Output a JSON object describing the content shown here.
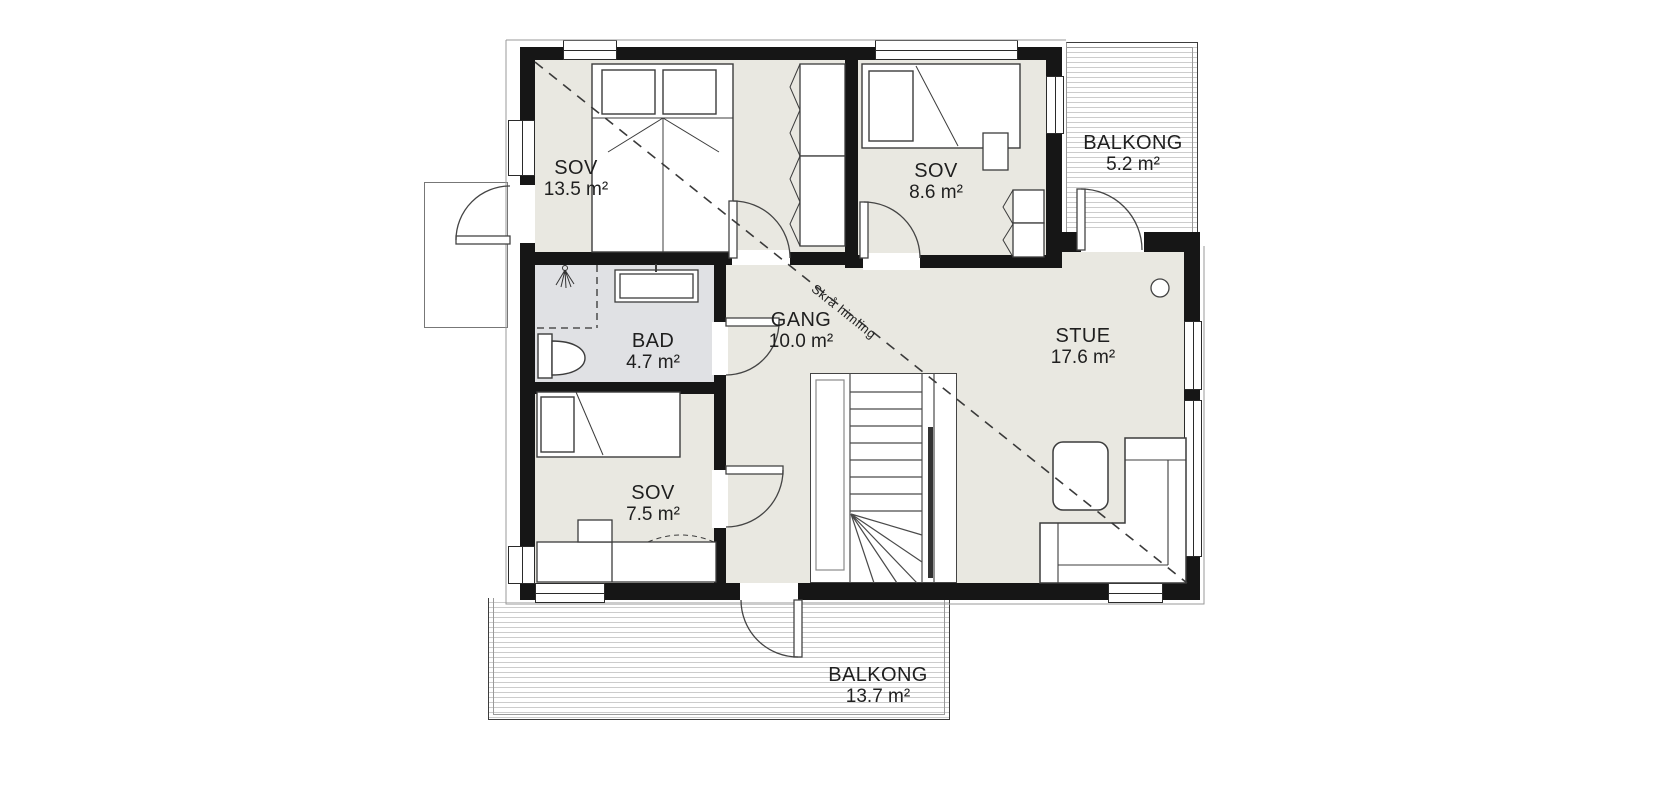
{
  "labels": {
    "rooms": [
      {
        "name": "SOV",
        "area": "13.5 m²"
      },
      {
        "name": "SOV",
        "area": "8.6 m²"
      },
      {
        "name": "BALKONG",
        "area": "5.2 m²"
      },
      {
        "name": "BAD",
        "area": "4.7 m²"
      },
      {
        "name": "GANG",
        "area": "10.0 m²"
      },
      {
        "name": "STUE",
        "area": "17.6 m²"
      },
      {
        "name": "SOV",
        "area": "7.5 m²"
      },
      {
        "name": "BALKONG",
        "area": "13.7 m²"
      }
    ],
    "annotation": {
      "sloped_ceiling": "Skrå himling"
    }
  },
  "features": [
    "double-bed",
    "single-bed",
    "wardrobe",
    "toilet",
    "sink",
    "shower",
    "stairs",
    "sofa",
    "coffee-table",
    "door-swing",
    "window",
    "balcony-deck",
    "sloped-ceiling-line"
  ],
  "colors": {
    "wall": "#161616",
    "floor": "#e9e8e1",
    "bathroom_floor": "#e0e1e4",
    "deck_hatch": "#cccccc",
    "line": "#3c3c3c",
    "text": "#1f1f1f"
  }
}
